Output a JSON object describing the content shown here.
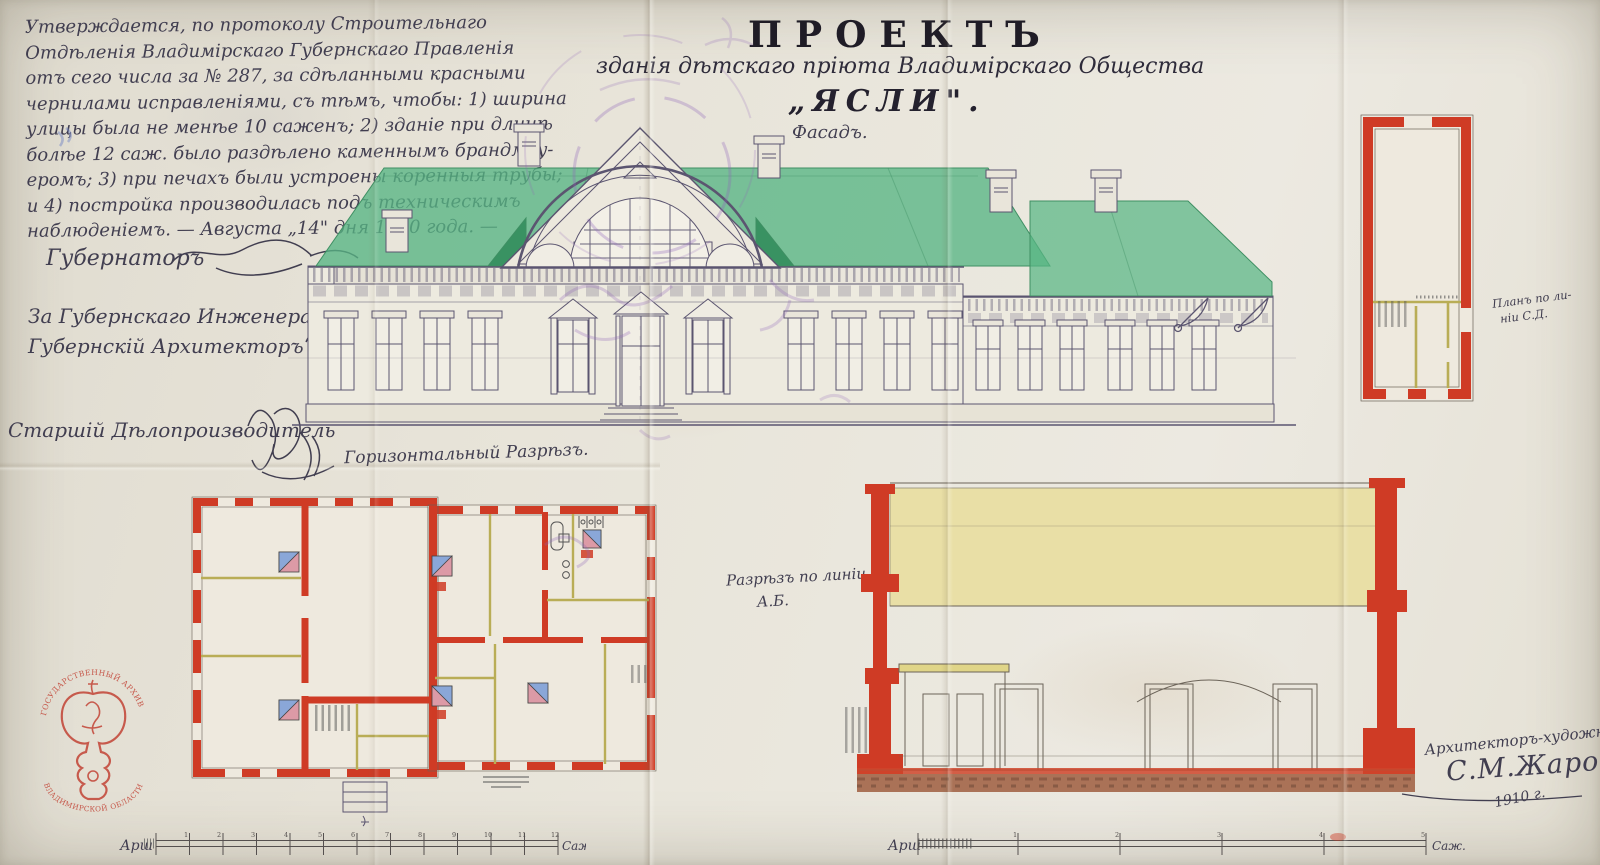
{
  "document": {
    "title": {
      "main": "ПРОЕКТЪ",
      "subtitle": "зданія дѣтскаго пріюта Владимірскаго Общества",
      "name": "„ЯСЛИ\".",
      "view_label": "Фасадъ."
    },
    "approval": {
      "lines": [
        "Утверждается, по протоколу Строительнаго",
        "Отдѣленія Владимірскаго Губернскаго Правленія",
        "отъ сего числа за № 287, за сдѣланными красными",
        "чернилами исправленіями, съ тѣмъ, чтобы: 1) ширина",
        "улицы была не менѣе 10 саженъ; 2) зданіе при длинѣ",
        "болѣе 12 саж. было раздѣлено каменнымъ брандмау-",
        "еромъ; 3) при печахъ были устроены коренныя трубы;",
        "и 4) постройка производилась подъ техническимъ",
        "наблюденіемъ. — Августа „14\" дня 1910 года. —"
      ]
    },
    "signatures": {
      "governor": "Губернаторъ",
      "engineer_for": "За Губернскаго Инженера,",
      "engineer_title": "Губернскій Архитекторъ",
      "clerk": "Старшій Дѣлопроизводитель"
    },
    "drawing_labels": {
      "floor_plan": "Горизонтальный Разрѣзъ.",
      "section_1": "Разрѣзъ по линіи",
      "section_2": "А.Б.",
      "small_plan_1": "Планъ по ли-",
      "small_plan_2": "ніи С.Д."
    },
    "architect_block": {
      "title": "Архитекторъ-художникъ",
      "signature": "С.М.Жаровъ",
      "year": "1910 г."
    },
    "archive_stamp": {
      "top": "ГОСУДАРСТВЕННЫЙ АРХИВ",
      "bottom": "ВЛАДИМИРСКОЙ ОБЛАСТИ"
    },
    "scales": {
      "left": {
        "start_label": "Арш",
        "end_label": "Саж.",
        "ticks": [
          "1",
          "2",
          "3",
          "4",
          "5",
          "6",
          "7",
          "8",
          "9",
          "10",
          "11",
          "12"
        ]
      },
      "right": {
        "start_label": "Арш",
        "end_label": "Саж.",
        "ticks": [
          "1",
          "2",
          "3",
          "4",
          "5"
        ]
      }
    },
    "colors": {
      "paper": "#e7e3d8",
      "ink": "#45415a",
      "wall_red": "#cf3b25",
      "roof_green": "#55b07f",
      "wood_yellow": "#cfc36a",
      "stamp_red": "#bf3527",
      "office_stamp_purple": "#8f63b8"
    }
  }
}
